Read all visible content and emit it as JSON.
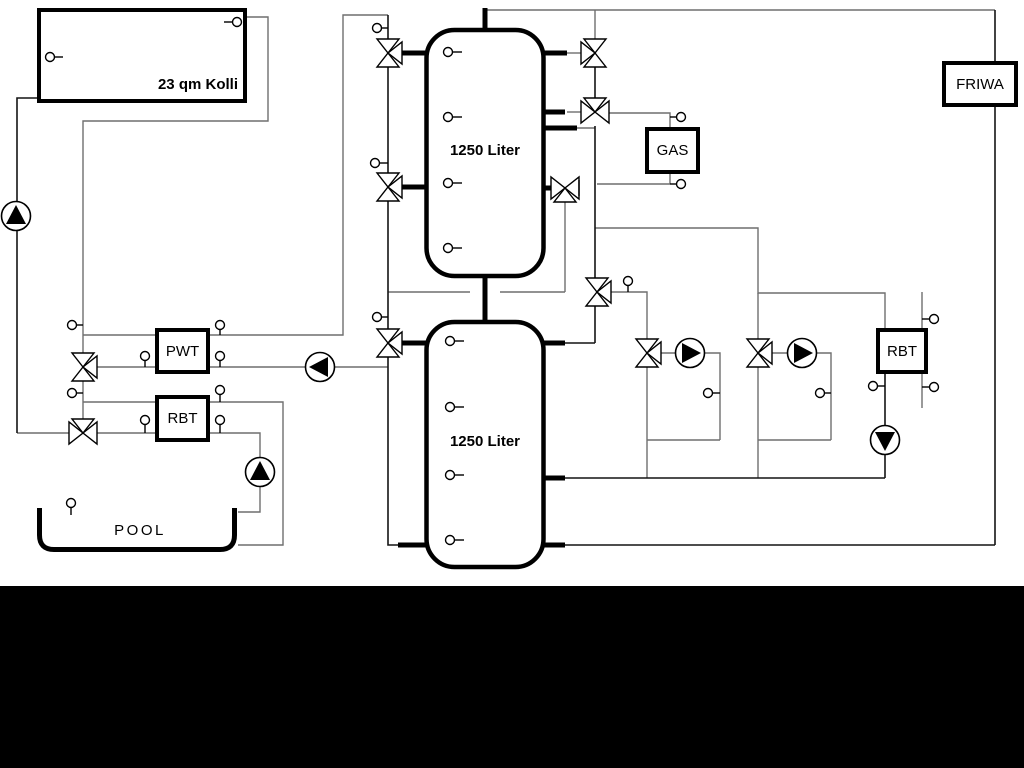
{
  "diagram": {
    "collector": {
      "label": "23 qm Kolli"
    },
    "tanks": [
      {
        "label": "1250 Liter"
      },
      {
        "label": "1250 Liter"
      }
    ],
    "boxes": {
      "gas": "GAS",
      "friwa": "FRIWA",
      "pwt": "PWT",
      "rbt_left": "RBT",
      "rbt_right": "RBT"
    },
    "pool": {
      "label": "POOL"
    },
    "colors": {
      "pipe_gray": "#6f6f6f",
      "pipe_dark": "#141414",
      "component_outline": "#000000",
      "background": "#ffffff",
      "bottom_band": "#000000"
    }
  }
}
